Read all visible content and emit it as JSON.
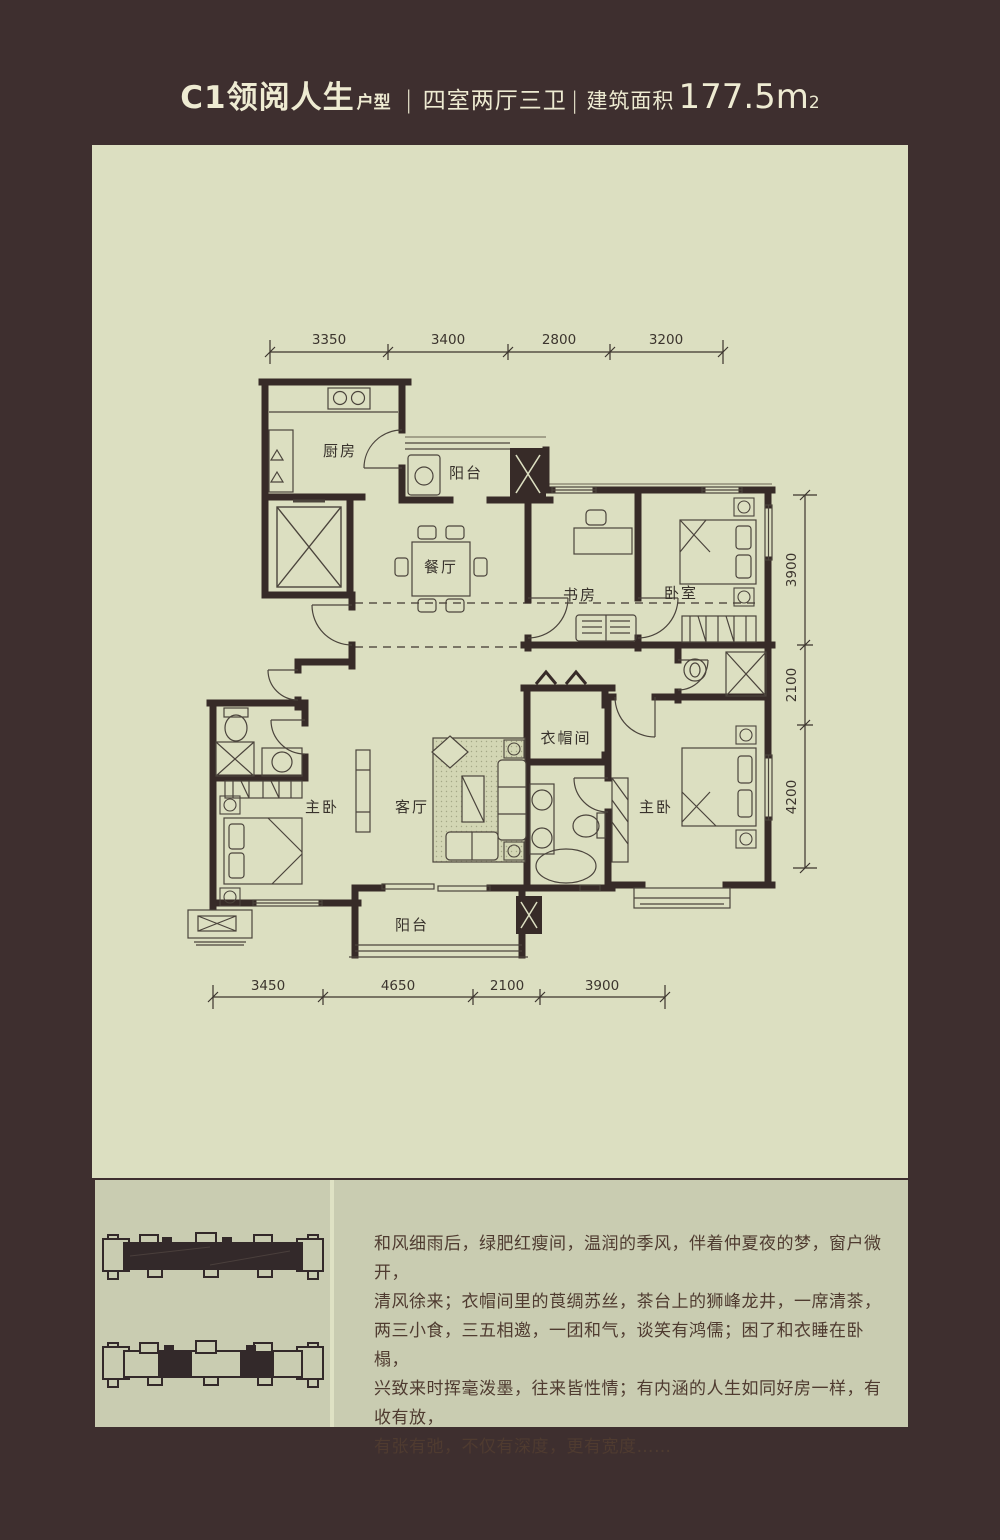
{
  "colors": {
    "frame": "#3e2f2f",
    "panel": "#dcdfc1",
    "box": "#c9ccb1",
    "wall": "#372b28",
    "cream": "#eeebd2"
  },
  "header": {
    "code_name": "C1领阅人生",
    "suffix": "户型",
    "divider1": "|",
    "layout": "四室两厅三卫",
    "divider2": "|",
    "area_label": "建筑面积",
    "area_value": "177.5m",
    "area_exponent": "2"
  },
  "floorplan": {
    "rooms": [
      {
        "id": "kitchen",
        "label": "厨房"
      },
      {
        "id": "balcony-top",
        "label": "阳台"
      },
      {
        "id": "dining",
        "label": "餐厅"
      },
      {
        "id": "study",
        "label": "书房"
      },
      {
        "id": "bedroom",
        "label": "卧室"
      },
      {
        "id": "master-left",
        "label": "主卧"
      },
      {
        "id": "living",
        "label": "客厅"
      },
      {
        "id": "cloakroom",
        "label": "衣帽间"
      },
      {
        "id": "master-right",
        "label": "主卧"
      },
      {
        "id": "balcony-bottom",
        "label": "阳台"
      }
    ],
    "dims_top": [
      "3350",
      "3400",
      "2800",
      "3200"
    ],
    "dims_right": [
      "3900",
      "2100",
      "4200"
    ],
    "dims_bottom": [
      "3450",
      "4650",
      "2100",
      "3900"
    ]
  },
  "description": {
    "lines": [
      "和风细雨后，绿肥红瘦间，温润的季风，伴着仲夏夜的梦，窗户微开，",
      "清风徐来；衣帽间里的莨绸苏丝，茶台上的狮峰龙井，一席清茶，",
      "两三小食，三五相邀，一团和气，谈笑有鸿儒；困了和衣睡在卧榻，",
      "兴致来时挥毫泼墨，往来皆性情；有内涵的人生如同好房一样，有收有放，",
      "有张有弛，不仅有深度，更有宽度……"
    ]
  }
}
